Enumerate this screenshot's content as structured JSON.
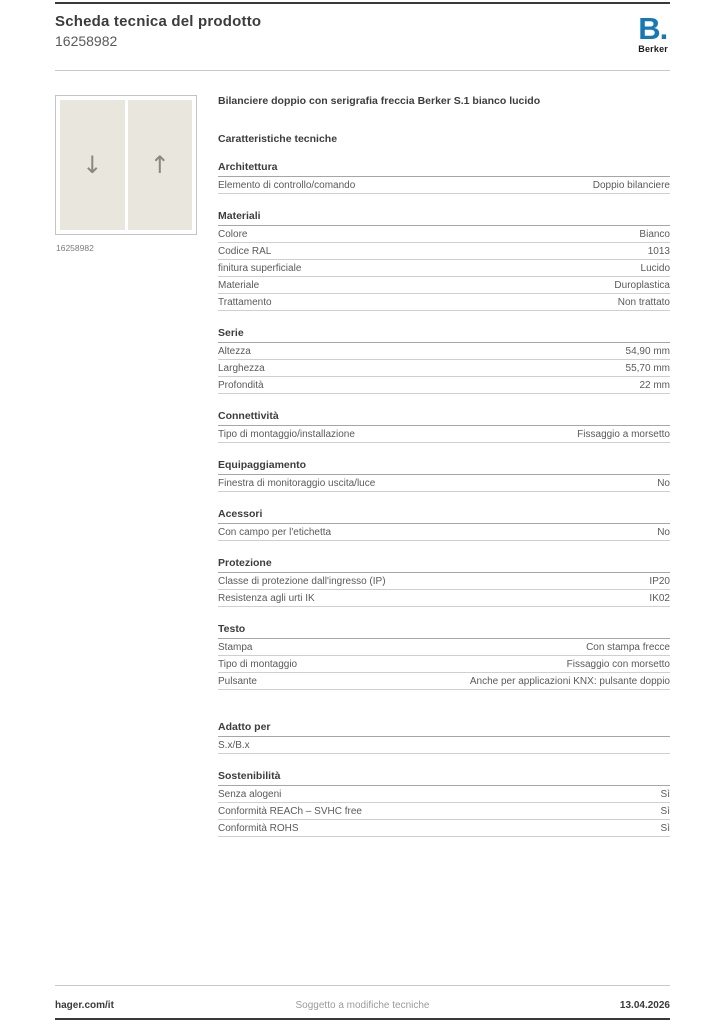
{
  "header": {
    "doc_title": "Scheda tecnica del prodotto",
    "product_number": "16258982"
  },
  "logo": {
    "mark": "B.",
    "name": "Berker",
    "brand_color": "#1878b4"
  },
  "product": {
    "title": "Bilanciere doppio con serigrafia freccia Berker S.1 bianco lucido",
    "image_caption": "16258982",
    "arrow_down": "↓",
    "arrow_up": "↑"
  },
  "specs": {
    "heading": "Caratteristiche tecniche",
    "sections": [
      {
        "name": "Architettura",
        "rows": [
          {
            "label": "Elemento di controllo/comando",
            "value": "Doppio bilanciere"
          }
        ]
      },
      {
        "name": "Materiali",
        "rows": [
          {
            "label": "Colore",
            "value": "Bianco"
          },
          {
            "label": "Codice RAL",
            "value": "1013"
          },
          {
            "label": "finitura superficiale",
            "value": "Lucido"
          },
          {
            "label": "Materiale",
            "value": "Duroplastica"
          },
          {
            "label": "Trattamento",
            "value": "Non trattato"
          }
        ]
      },
      {
        "name": "Serie",
        "rows": [
          {
            "label": "Altezza",
            "value": "54,90 mm"
          },
          {
            "label": "Larghezza",
            "value": "55,70 mm"
          },
          {
            "label": "Profondità",
            "value": "22 mm"
          }
        ]
      },
      {
        "name": "Connettività",
        "rows": [
          {
            "label": "Tipo di montaggio/installazione",
            "value": "Fissaggio a morsetto"
          }
        ]
      },
      {
        "name": "Equipaggiamento",
        "rows": [
          {
            "label": "Finestra di monitoraggio uscita/luce",
            "value": "No"
          }
        ]
      },
      {
        "name": "Acessori",
        "rows": [
          {
            "label": "Con campo per l'etichetta",
            "value": "No"
          }
        ]
      },
      {
        "name": "Protezione",
        "rows": [
          {
            "label": "Classe di protezione dall'ingresso (IP)",
            "value": "IP20"
          },
          {
            "label": "Resistenza agli urti IK",
            "value": "IK02"
          }
        ]
      },
      {
        "name": "Testo",
        "rows": [
          {
            "label": "Stampa",
            "value": "Con stampa frecce"
          },
          {
            "label": "Tipo di montaggio",
            "value": "Fissaggio con morsetto"
          },
          {
            "label": "Pulsante",
            "value": "Anche per applicazioni KNX: pulsante doppio"
          }
        ]
      },
      {
        "name": "Adatto per",
        "extra_gap": true,
        "rows": [
          {
            "label": "S.x/B.x",
            "value": ""
          }
        ]
      },
      {
        "name": "Sostenibilità",
        "rows": [
          {
            "label": "Senza alogeni",
            "value": "Sì"
          },
          {
            "label": "Conformità REACh – SVHC free",
            "value": "Sì"
          },
          {
            "label": "Conformità ROHS",
            "value": "Sì"
          }
        ]
      }
    ]
  },
  "footer": {
    "left": "hager.com/it",
    "center": "Soggetto a modifiche tecniche",
    "right": "13.04.2026"
  }
}
